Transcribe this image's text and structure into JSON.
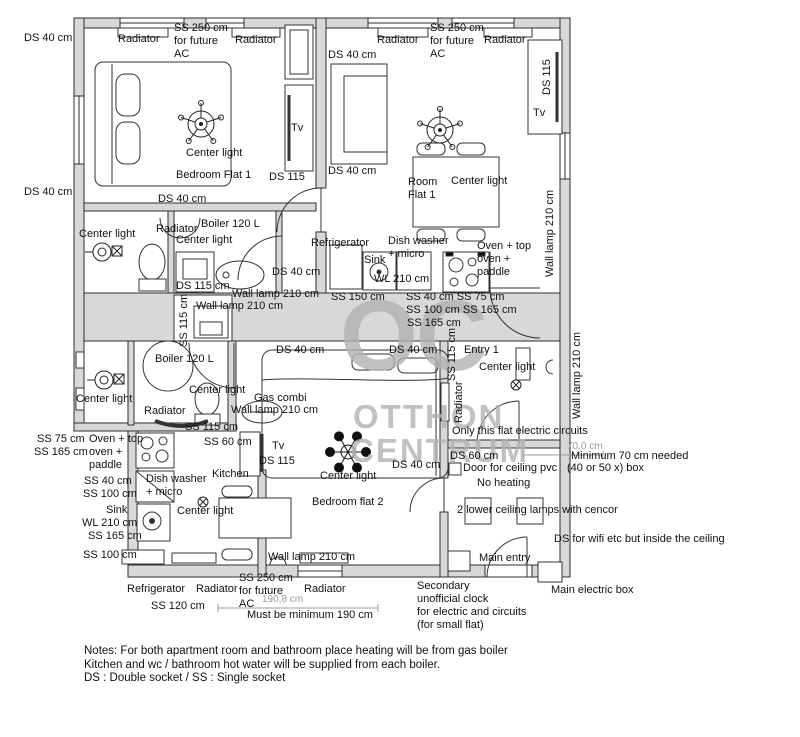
{
  "watermark": {
    "oc": "OC",
    "line1": "OTTHON",
    "line2": "CENTRUM"
  },
  "notes": "Notes: For both apartment room and bathroom place heating will be from gas boiler\nKitchen and wc / bathroom hot water will be supplied from each boiler.\nDS : Double socket / SS : Single socket",
  "colors": {
    "wall_fill": "#d8d8d8",
    "line": "#2e2e2e",
    "dim": "#9b9b9b",
    "watermark": "#b2b2b2"
  },
  "legend": {
    "ds": "DS : Double socket",
    "ss": "SS : Single socket"
  },
  "labels": [
    {
      "t": "DS 40 cm",
      "x": 24,
      "y": 32
    },
    {
      "t": "DS 40 cm",
      "x": 24,
      "y": 186
    },
    {
      "t": "Radiator",
      "x": 118,
      "y": 33
    },
    {
      "t": "SS 250 cm\nfor future\nAC",
      "x": 174,
      "y": 22
    },
    {
      "t": "Radiator",
      "x": 235,
      "y": 34
    },
    {
      "t": "Tv",
      "x": 291,
      "y": 122
    },
    {
      "t": "Center light",
      "x": 186,
      "y": 147
    },
    {
      "t": "Bedroom Flat 1",
      "x": 176,
      "y": 169
    },
    {
      "t": "DS 115",
      "x": 269,
      "y": 171
    },
    {
      "t": "DS 40 cm",
      "x": 158,
      "y": 193
    },
    {
      "t": "DS 40 cm",
      "x": 328,
      "y": 49
    },
    {
      "t": "Radiator",
      "x": 377,
      "y": 34
    },
    {
      "t": "SS 250 cm\nfor future\nAC",
      "x": 430,
      "y": 22
    },
    {
      "t": "Radiator",
      "x": 484,
      "y": 34
    },
    {
      "t": "DS 115",
      "x": 541,
      "y": 95,
      "r": -90
    },
    {
      "t": "Tv",
      "x": 533,
      "y": 107
    },
    {
      "t": "DS 40 cm",
      "x": 328,
      "y": 165
    },
    {
      "t": "Room\nFlat 1",
      "x": 408,
      "y": 176
    },
    {
      "t": "Center light",
      "x": 451,
      "y": 175
    },
    {
      "t": "Wall lamp 210 cm",
      "x": 544,
      "y": 277,
      "r": -90
    },
    {
      "t": "Center light",
      "x": 79,
      "y": 228
    },
    {
      "t": "Radiator",
      "x": 156,
      "y": 223
    },
    {
      "t": "Boiler 120 L",
      "x": 201,
      "y": 218
    },
    {
      "t": "Center light",
      "x": 176,
      "y": 234
    },
    {
      "t": "DS 115 cm",
      "x": 176,
      "y": 280
    },
    {
      "t": "DS 40 cm",
      "x": 272,
      "y": 266
    },
    {
      "t": "Wall lamp 210 cm",
      "x": 232,
      "y": 288
    },
    {
      "t": "Wall lamp 210 cm",
      "x": 196,
      "y": 300
    },
    {
      "t": "SS 115 cm",
      "x": 178,
      "y": 347,
      "r": -90
    },
    {
      "t": "Refrigerator",
      "x": 311,
      "y": 237
    },
    {
      "t": "Dish washer\n+ micro",
      "x": 388,
      "y": 235
    },
    {
      "t": "Sink",
      "x": 364,
      "y": 254
    },
    {
      "t": "WL 210 cm",
      "x": 374,
      "y": 273
    },
    {
      "t": "Oven + top\noven +\npaddle",
      "x": 477,
      "y": 240
    },
    {
      "t": "SS 150 cm",
      "x": 331,
      "y": 291
    },
    {
      "t": "SS 40 cm SS 75 cm",
      "x": 406,
      "y": 291
    },
    {
      "t": "SS 100 cm SS 165 cm",
      "x": 406,
      "y": 304
    },
    {
      "t": "SS 165 cm",
      "x": 407,
      "y": 317
    },
    {
      "t": "Boiler 120 L",
      "x": 155,
      "y": 353
    },
    {
      "t": "DS 40 cm",
      "x": 276,
      "y": 344
    },
    {
      "t": "DS 40 cm",
      "x": 389,
      "y": 344
    },
    {
      "t": "Center light",
      "x": 76,
      "y": 393
    },
    {
      "t": "Center light",
      "x": 189,
      "y": 384
    },
    {
      "t": "Radiator",
      "x": 144,
      "y": 405
    },
    {
      "t": "Gas combi",
      "x": 254,
      "y": 392
    },
    {
      "t": "Wall lamp 210 cm",
      "x": 231,
      "y": 404
    },
    {
      "t": "SS 115 cm",
      "x": 185,
      "y": 421
    },
    {
      "t": "SS 60 cm",
      "x": 204,
      "y": 436
    },
    {
      "t": "Tv",
      "x": 272,
      "y": 440
    },
    {
      "t": "DS 115",
      "x": 259,
      "y": 455
    },
    {
      "t": "SS 75 cm",
      "x": 37,
      "y": 433
    },
    {
      "t": "SS 165 cm",
      "x": 34,
      "y": 446
    },
    {
      "t": "Oven + top\noven +\npaddle",
      "x": 89,
      "y": 433
    },
    {
      "t": "SS 40 cm",
      "x": 84,
      "y": 475
    },
    {
      "t": "SS 100 cm",
      "x": 83,
      "y": 488
    },
    {
      "t": "Sink",
      "x": 106,
      "y": 504
    },
    {
      "t": "WL 210 cm",
      "x": 82,
      "y": 517
    },
    {
      "t": "SS 165 cm",
      "x": 88,
      "y": 530
    },
    {
      "t": "SS 100 cm",
      "x": 83,
      "y": 549
    },
    {
      "t": "Dish washer\n+ micro",
      "x": 146,
      "y": 473
    },
    {
      "t": "Kitchen",
      "x": 212,
      "y": 468
    },
    {
      "t": "Center light",
      "x": 177,
      "y": 505
    },
    {
      "t": "DS 40 cm",
      "x": 392,
      "y": 459
    },
    {
      "t": "Center light",
      "x": 320,
      "y": 470
    },
    {
      "t": "Bedroom flat 2",
      "x": 312,
      "y": 496
    },
    {
      "t": "Entry 1",
      "x": 464,
      "y": 344
    },
    {
      "t": "Center light",
      "x": 479,
      "y": 361
    },
    {
      "t": "SS 115 cm",
      "x": 446,
      "y": 381,
      "r": -90
    },
    {
      "t": "Radiator",
      "x": 453,
      "y": 423,
      "r": -90
    },
    {
      "t": "Only this flat electric circuits",
      "x": 452,
      "y": 425
    },
    {
      "t": "Wall lamp 210 cm",
      "x": 571,
      "y": 419,
      "r": -90
    },
    {
      "t": "70,0 cm",
      "x": 567,
      "y": 441,
      "c": "dim"
    },
    {
      "t": "DS 60 cm",
      "x": 450,
      "y": 450
    },
    {
      "t": "Door for ceiling pvc",
      "x": 463,
      "y": 462
    },
    {
      "t": "Minimum 70 cm needed",
      "x": 571,
      "y": 450
    },
    {
      "t": "(40 or 50 x) box",
      "x": 567,
      "y": 462
    },
    {
      "t": "No heating",
      "x": 477,
      "y": 477
    },
    {
      "t": "2 lower ceiling lamps with cencor",
      "x": 457,
      "y": 504
    },
    {
      "t": "DS for wifi etc but inside the ceiling",
      "x": 554,
      "y": 533
    },
    {
      "t": "Main entry",
      "x": 479,
      "y": 552
    },
    {
      "t": "Main electric box",
      "x": 551,
      "y": 584
    },
    {
      "t": "Secondary\nunofficial clock\nfor electric and circuits\n(for small flat)",
      "x": 417,
      "y": 580
    },
    {
      "t": "Wall lamp 210 cm",
      "x": 268,
      "y": 551
    },
    {
      "t": "Refrigerator",
      "x": 127,
      "y": 583
    },
    {
      "t": "Radiator",
      "x": 196,
      "y": 583
    },
    {
      "t": "SS 250 cm\nfor future\nAC",
      "x": 239,
      "y": 572
    },
    {
      "t": "190,8 cm",
      "x": 262,
      "y": 594,
      "c": "dim"
    },
    {
      "t": "Radiator",
      "x": 304,
      "y": 583
    },
    {
      "t": "SS 120 cm",
      "x": 151,
      "y": 600
    },
    {
      "t": "Must be minimum 190 cm",
      "x": 247,
      "y": 609
    }
  ]
}
